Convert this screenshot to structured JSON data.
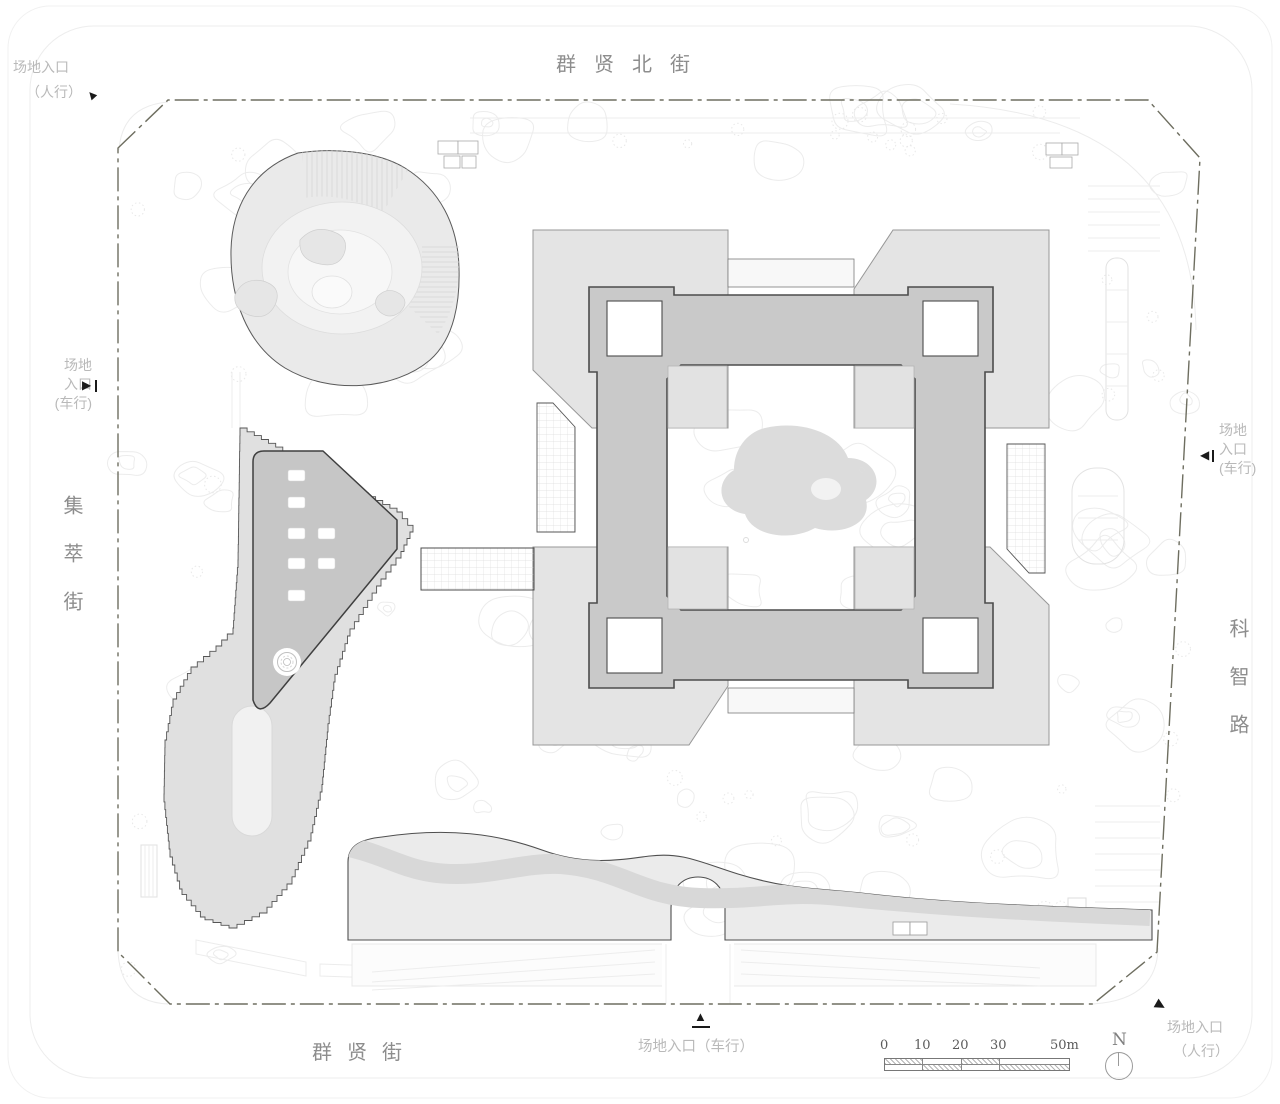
{
  "streets": {
    "north": "群贤北街",
    "south": "群贤街",
    "west": "集萃街",
    "east": "科智路"
  },
  "entrances": {
    "northwest_pedestrian": {
      "line1": "场地入口",
      "line2": "（人行）"
    },
    "west_vehicular": {
      "line1": "场地",
      "line2": "入口",
      "line3": "(车行)"
    },
    "east_vehicular": {
      "line1": "场地",
      "line2": "入口",
      "line3": "(车行)"
    },
    "south_vehicular": {
      "label": "场地入口（车行）"
    },
    "southeast_pedestrian": {
      "line1": "场地入口",
      "line2": "（人行）"
    }
  },
  "scale_bar": {
    "labels": [
      "0",
      "10",
      "20",
      "30",
      "50m"
    ]
  },
  "north_arrow": {
    "label": "N"
  },
  "icons": {
    "triangle_up": "▲",
    "triangle_right": "▶",
    "triangle_left": "◀"
  },
  "colors": {
    "background": "#ffffff",
    "linework_faint": "#ececec",
    "boundary_line": "#6e6e60",
    "ring_building": "#c9c9c9",
    "ring_outline": "#4c4c4c",
    "wing_building": "#e4e4e4",
    "wing_outline": "#979797",
    "podium_building": "#c6c6c6",
    "podium_outline": "#3f3f3f",
    "terrace_band": "#e0e0e0",
    "berm_fill": "#ebebeb",
    "river": "#d8d8d8",
    "courtyard_patch": "#e2e2e2",
    "pond": "#dcdcdc",
    "street_label": "#8d8d8d",
    "entrance_label": "#b9b9b9",
    "marker": "#1a1a1a",
    "scale_text": "#5a5a5a"
  }
}
